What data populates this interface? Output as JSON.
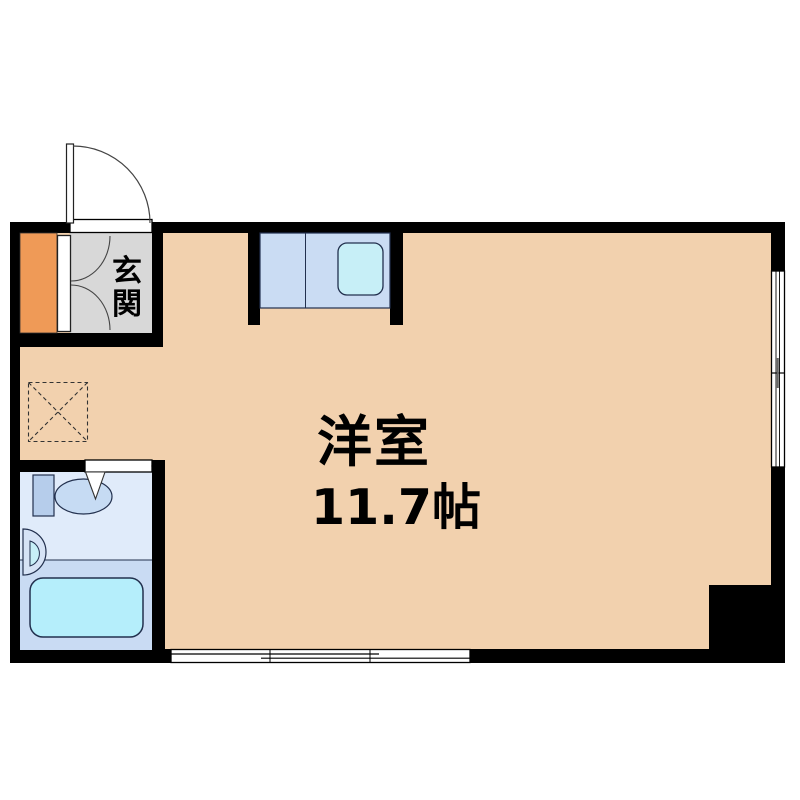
{
  "document": {
    "type": "apartment-floor-plan",
    "orientation": "single-room studio plan"
  },
  "rooms": {
    "main_room": {
      "label": "洋室",
      "area": "11.7帖"
    },
    "entrance": {
      "label": "玄関",
      "label_chars": [
        "玄",
        "関"
      ]
    }
  },
  "fixtures": [
    "entrance-swing-door",
    "shoe-closet-double-doors",
    "orange-closet-box",
    "kitchen-counter",
    "kitchen-sink",
    "washing-machine-space-dashed",
    "toilet",
    "wash-basin",
    "bathtub",
    "bathroom-door-triangle-marker",
    "sliding-window-bottom",
    "sliding-window-right"
  ],
  "palette": {
    "wall": "#000000",
    "floor_peach": "#f2d1ae",
    "genkan_gray": "#d8d8d8",
    "closet_orange": "#ef9a57",
    "counter_blue": "#cadcf3",
    "sink_cyan": "#c7eff7",
    "bath_upper_blue": "#e0ebfa",
    "bath_lower_blue": "#c9dbf3",
    "bathtub_cyan": "#b5eefb",
    "toilet_tank_blue": "#b6cdeb",
    "toilet_bowl_blue": "#c6dbf3",
    "fixture_outline": "#22304e",
    "background": "#ffffff"
  }
}
